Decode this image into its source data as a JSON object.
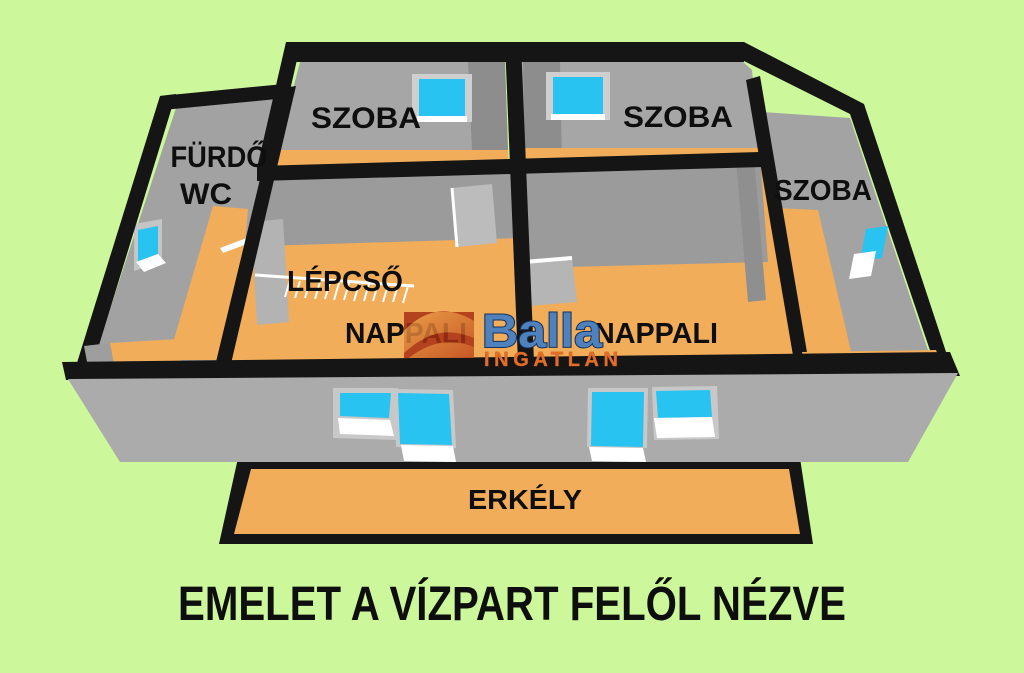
{
  "title": "EMELET A VÍZPART FELŐL NÉZVE",
  "rooms": {
    "szoba_top_left": "SZOBA",
    "szoba_top_right": "SZOBA",
    "szoba_right_wing": "SZOBA",
    "furdo": "FÜRDŐ",
    "wc": "WC",
    "lepcso": "LÉPCSŐ",
    "nappali_left": "NAPPALI",
    "nappali_right": "NAPPALI",
    "erkely": "ERKÉLY"
  },
  "watermark": {
    "brand": "Balla",
    "subtitle": "INGATLAN"
  },
  "colors": {
    "background": "#ccf79b",
    "floor_orange": "#f1ad59",
    "wall_gray": "#a9a9a9",
    "wall_gray_dark": "#8d8d8d",
    "outline_black": "#151515",
    "window_glass_cyan": "#29c3f1",
    "window_trim_white": "#ffffff",
    "logo_blue": "#4f82bc",
    "logo_blue_outline": "#16335c",
    "logo_orange": "#e06d28",
    "logo_box_red": "#a93014"
  }
}
